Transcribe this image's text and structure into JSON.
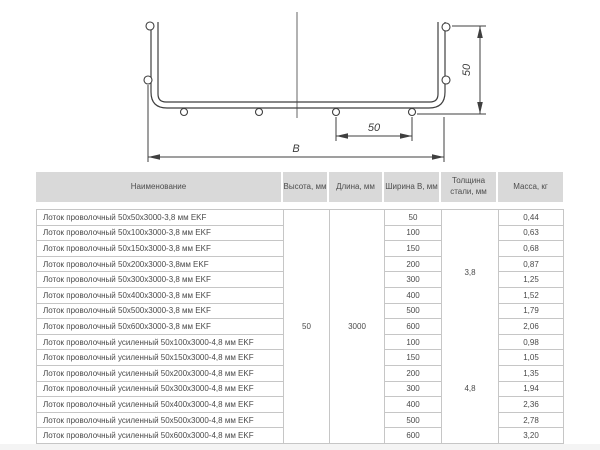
{
  "drawing": {
    "dim_side_height": "50",
    "dim_wire_spacing": "50",
    "dim_width_label": "В"
  },
  "table": {
    "headers": [
      "Наименование",
      "Высота, мм",
      "Длина, мм",
      "Ширина В, мм",
      "Толщина стали, мм",
      "Масса, кг"
    ],
    "merged": {
      "height": "50",
      "length": "3000",
      "thickness_a": "3,8",
      "thickness_b": "4,8"
    },
    "rows": [
      {
        "name": "Лоток проволочный 50х50х3000-3,8 мм EKF",
        "width": "50",
        "mass": "0,44"
      },
      {
        "name": "Лоток проволочный 50х100х3000-3,8 мм EKF",
        "width": "100",
        "mass": "0,63"
      },
      {
        "name": "Лоток проволочный 50х150х3000-3,8 мм EKF",
        "width": "150",
        "mass": "0,68"
      },
      {
        "name": "Лоток проволочный 50х200х3000-3,8мм EKF",
        "width": "200",
        "mass": "0,87"
      },
      {
        "name": "Лоток проволочный 50х300х3000-3,8 мм EKF",
        "width": "300",
        "mass": "1,25"
      },
      {
        "name": "Лоток проволочный 50х400х3000-3,8 мм EKF",
        "width": "400",
        "mass": "1,52"
      },
      {
        "name": "Лоток проволочный 50х500х3000-3,8 мм EKF",
        "width": "500",
        "mass": "1,79"
      },
      {
        "name": "Лоток проволочный 50х600х3000-3,8 мм EKF",
        "width": "600",
        "mass": "2,06"
      },
      {
        "name": "Лоток проволочный усиленный 50х100х3000-4,8 мм EKF",
        "width": "100",
        "mass": "0,98"
      },
      {
        "name": "Лоток проволочный усиленный 50х150х3000-4,8 мм EKF",
        "width": "150",
        "mass": "1,05"
      },
      {
        "name": "Лоток проволочный усиленный 50х200х3000-4,8 мм EKF",
        "width": "200",
        "mass": "1,35"
      },
      {
        "name": "Лоток проволочный усиленный 50х300х3000-4,8 мм EKF",
        "width": "300",
        "mass": "1,94"
      },
      {
        "name": "Лоток проволочный усиленный 50х400х3000-4,8 мм EKF",
        "width": "400",
        "mass": "2,36"
      },
      {
        "name": "Лоток проволочный усиленный 50х500х3000-4,8 мм EKF",
        "width": "500",
        "mass": "2,78"
      },
      {
        "name": "Лоток проволочный усиленный 50х600х3000-4,8 мм EKF",
        "width": "600",
        "mass": "3,20"
      }
    ]
  },
  "colors": {
    "header_bg": "#d9d9d9",
    "table_border": "#c6c6c6",
    "text": "#4a4a4a",
    "drawing_stroke": "#3f3f3f"
  }
}
